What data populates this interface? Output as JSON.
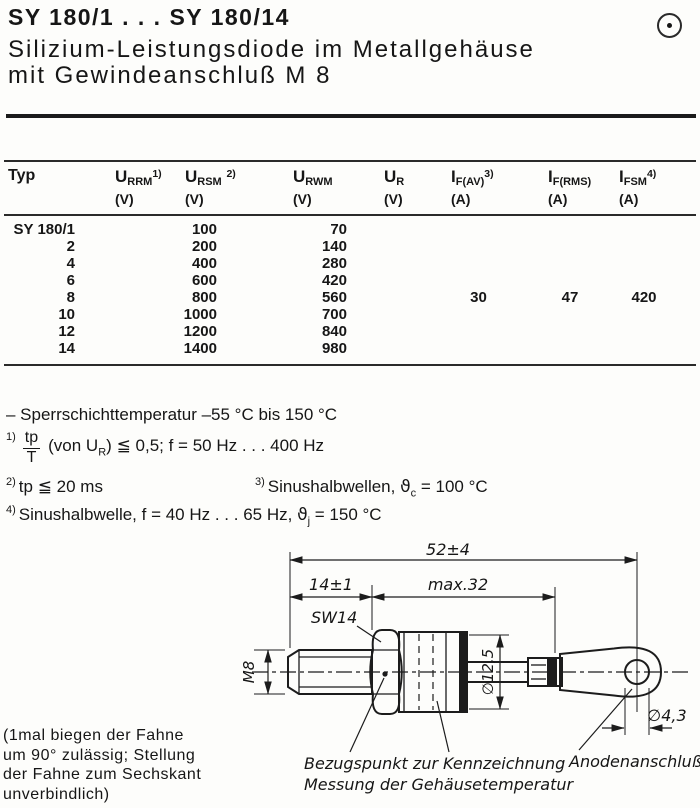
{
  "header": {
    "title": "SY 180/1 . . . SY 180/14",
    "subtitle1": "Silizium-Leistungsdiode im Metallgehäuse",
    "subtitle2": "mit Gewindeanschluß M 8",
    "corner_icon": "circled-dot"
  },
  "table": {
    "typ_header": "Typ",
    "headers": [
      {
        "base": "U",
        "sub": "RRM",
        "sup": "1)",
        "unit": "(V)"
      },
      {
        "base": "U",
        "sub": "RSM",
        "sup": "2)",
        "unit": "(V)"
      },
      {
        "base": "U",
        "sub": "RWM",
        "sup": "",
        "unit": "(V)"
      },
      {
        "base": "U",
        "sub": "R",
        "sup": "",
        "unit": "(V)"
      },
      {
        "base": "I",
        "sub": "F(AV)",
        "sup": "3)",
        "unit": "(A)"
      },
      {
        "base": "I",
        "sub": "F(RMS)",
        "sup": "",
        "unit": "(A)"
      },
      {
        "base": "I",
        "sub": "FSM",
        "sup": "4)",
        "unit": "(A)"
      }
    ],
    "rows": [
      {
        "typ": "SY 180/1",
        "urrm_ursm": "100",
        "urwm_ur": "70",
        "if_av": "",
        "if_rms": "",
        "i_fsm": ""
      },
      {
        "typ": "2",
        "urrm_ursm": "200",
        "urwm_ur": "140",
        "if_av": "",
        "if_rms": "",
        "i_fsm": ""
      },
      {
        "typ": "4",
        "urrm_ursm": "400",
        "urwm_ur": "280",
        "if_av": "",
        "if_rms": "",
        "i_fsm": ""
      },
      {
        "typ": "6",
        "urrm_ursm": "600",
        "urwm_ur": "420",
        "if_av": "",
        "if_rms": "",
        "i_fsm": ""
      },
      {
        "typ": "8",
        "urrm_ursm": "800",
        "urwm_ur": "560",
        "if_av": "30",
        "if_rms": "47",
        "i_fsm": "420"
      },
      {
        "typ": "10",
        "urrm_ursm": "1000",
        "urwm_ur": "700",
        "if_av": "",
        "if_rms": "",
        "i_fsm": ""
      },
      {
        "typ": "12",
        "urrm_ursm": "1200",
        "urwm_ur": "840",
        "if_av": "",
        "if_rms": "",
        "i_fsm": ""
      },
      {
        "typ": "14",
        "urrm_ursm": "1400",
        "urwm_ur": "980",
        "if_av": "",
        "if_rms": "",
        "i_fsm": ""
      }
    ]
  },
  "notes": {
    "temp_range": "– Sperrschichttemperatur  –55 °C bis 150 °C",
    "n1": {
      "sup": "1)",
      "num": "tp",
      "den": "T",
      "a": "(von U",
      "sub": "R",
      "b": ")",
      "leq": "≦",
      "c": " 0,5;  f = 50 Hz . . . 400 Hz"
    },
    "n2": {
      "sup": "2)",
      "a": "tp ",
      "leq": "≦",
      "b": " 20 ms"
    },
    "n3": {
      "sup": "3)",
      "a": "Sinushalbwellen,  ",
      "theta": "ϑ",
      "sub": "c",
      "b": " = 100 °C"
    },
    "n4": {
      "sup": "4)",
      "a": "Sinushalbwelle,  f = 40 Hz . . . 65 Hz,  ",
      "theta": "ϑ",
      "sub": "j",
      "b": " = 150 °C"
    }
  },
  "drawing": {
    "dim_overall": "52±4",
    "dim_stud": "14±1",
    "dim_case": "max.32",
    "wrench_size": "SW14",
    "thread": "M8",
    "body_dia": "∅12,5",
    "hole_dia": "∅4,3",
    "ref_label_1": "Bezugspunkt zur",
    "ref_label_2": "Messung der Gehäusetemperatur",
    "marking_label": "Kennzeichnung",
    "anode_label": "Anodenanschluß"
  },
  "footnote": {
    "line1": "(1mal biegen der Fahne",
    "line2": "um 90° zulässig; Stellung",
    "line3": "der Fahne zum Sechskant",
    "line4": "unverbindlich)"
  }
}
